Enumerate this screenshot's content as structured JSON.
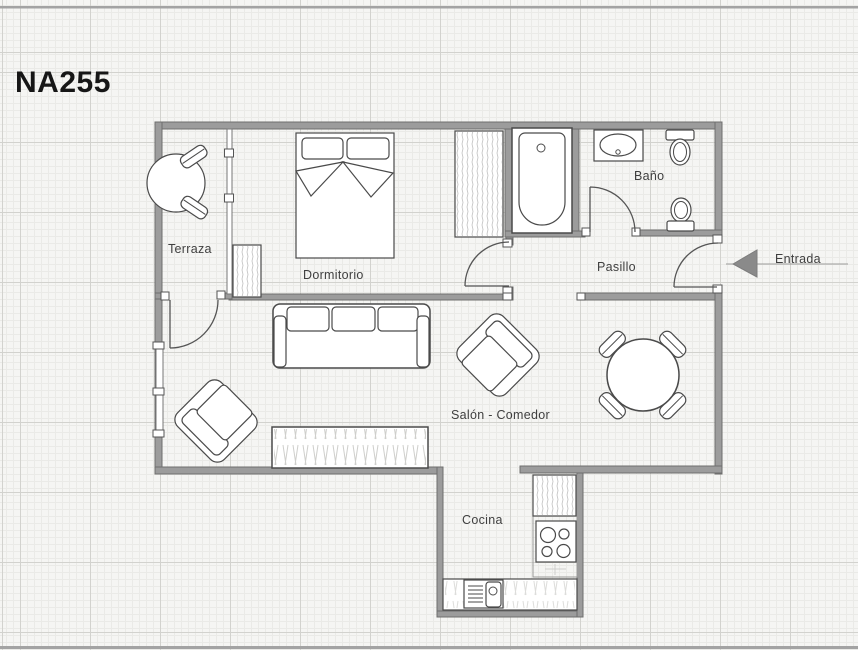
{
  "page": {
    "title": "NA255"
  },
  "plan": {
    "labels": {
      "terraza": "Terraza",
      "dormitorio": "Dormitorio",
      "bano": "Baño",
      "pasillo": "Pasillo",
      "salon": "Salón - Comedor",
      "cocina": "Cocina",
      "entrada": "Entrada"
    },
    "colors": {
      "wall_fill": "#9c9c9c",
      "wall_edge": "#6e6e6e",
      "furniture_line": "#4a4a4a",
      "label_text": "#3f3f3f",
      "paper": "#f5f5f3",
      "grid_fine": "#eaeae7",
      "grid_major": "#d2d2ce",
      "entry_arrow": "#8a8a8a"
    }
  }
}
